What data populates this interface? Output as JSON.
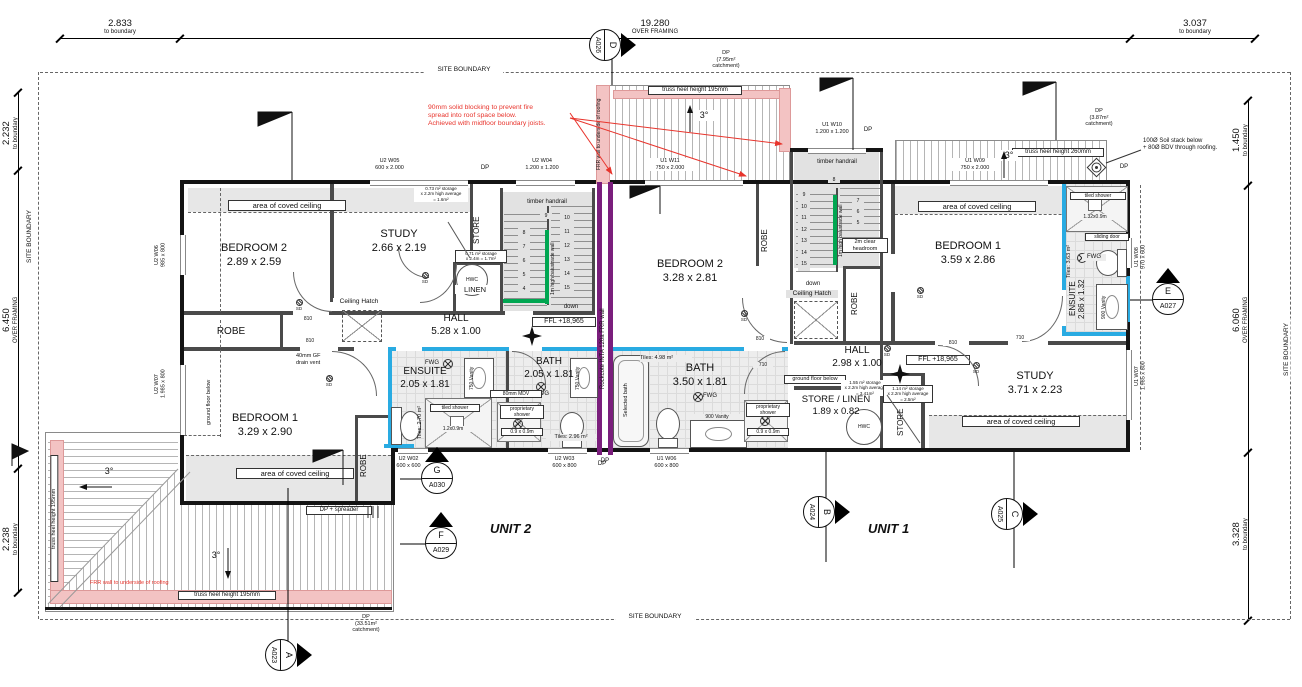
{
  "colors": {
    "frr_purple": "#7a1e7c",
    "wet_wall_cyan": "#29abe2",
    "balustrade_green": "#00a651",
    "annotation_red": "#e8342c",
    "frr_pink": "#f3c3c3"
  },
  "boundary_label": "SITE BOUNDARY",
  "dims": {
    "top_left": {
      "v": "2.833",
      "s": "to boundary"
    },
    "top_mid": {
      "v": "19.280",
      "s": "OVER FRAMING"
    },
    "top_right": {
      "v": "3.037",
      "s": "to boundary"
    },
    "left_top": {
      "v": "2.232",
      "s": "to boundary"
    },
    "left_mid": {
      "v": "6.450",
      "s": "OVER FRAMING"
    },
    "left_bot": {
      "v": "2.238",
      "s": "to boundary"
    },
    "right_top": {
      "v": "1.450",
      "s": "to boundary"
    },
    "right_mid": {
      "v": "6.060",
      "s": "OVER FRAMING"
    },
    "right_bot": {
      "v": "3.328",
      "s": "to boundary"
    }
  },
  "unit_labels": {
    "unit1": "UNIT 1",
    "unit2": "UNIT 2"
  },
  "markers": {
    "d": {
      "letter": "D",
      "sheet": "A026"
    },
    "e": {
      "letter": "E",
      "sheet": "A027"
    },
    "g": {
      "letter": "G",
      "sheet": "A030"
    },
    "f": {
      "letter": "F",
      "sheet": "A029"
    },
    "b": {
      "letter": "B",
      "sheet": "A024"
    },
    "c": {
      "letter": "C",
      "sheet": "A025"
    },
    "a": {
      "letter": "A",
      "sheet": "A023"
    }
  },
  "notes": {
    "fire_blocking": "90mm solid blocking to prevent fire\nspread into roof space below.\nAchieved with midfloor boundary joists.",
    "frr_underside": "FRR wall to underside of roofing",
    "frr_underside_2": "FRR wall to underside of roofing",
    "rockcote_wall": "Rockcote  INTA 120a FRR wall",
    "soil_stack": "100Ø Soil stack below\n+ 80Ø BDV through roofing.",
    "truss_195": "truss heel height 195mm",
    "truss_260": "truss heel height 260mm",
    "slope": "3°",
    "dp": "DP",
    "dp_spreader": "DP + spreader",
    "dp_795": "DP\n(7.95m²\ncatchment)",
    "dp_387": "DP\n(3.87m²\ncatchment)",
    "dp_3351": "DP\n(33.51m²\ncatchment)",
    "coved_ceiling": "area of coved ceiling",
    "ground_floor_below": "ground floor below",
    "ceiling_hatch": "Ceiling Hatch",
    "drain_vent": "40mm GF\ndrain vent",
    "sd": "SD",
    "fwg": "FWG",
    "mdv": "80mm MDV",
    "sliding_door": "sliding door"
  },
  "doors": {
    "d810": "810",
    "d710": "710"
  },
  "windows": {
    "u2w05": {
      "name": "U2 W05",
      "size": "600 x 2.000"
    },
    "u2w04": {
      "name": "U2 W04",
      "size": "1.200 x 1.200"
    },
    "u1w11": {
      "name": "U1 W11",
      "size": "750 x 2.000"
    },
    "u1w10": {
      "name": "U1 W10",
      "size": "1.200 x 1.200"
    },
    "u1w09": {
      "name": "U1 W09",
      "size": "750 x 2.000"
    },
    "u2w06": {
      "name": "U2 W06",
      "size": "985 x 800"
    },
    "u2w07": {
      "name": "U2 W07",
      "size": "1.985 x 800"
    },
    "u2w02": {
      "name": "U2 W02",
      "size": "600 x 600"
    },
    "u2w03": {
      "name": "U2 W03",
      "size": "600 x 800"
    },
    "u1w06": {
      "name": "U1 W06",
      "size": "600 x 800"
    },
    "u1w08": {
      "name": "U1 W08",
      "size": "970 x 600"
    },
    "u1w07": {
      "name": "U1 W07",
      "size": "1.985 x 800"
    }
  },
  "stairs": {
    "u2": {
      "handrail": "timber handrail",
      "balustrade": "1m high balustrade wall",
      "up_numbers": "8\n7\n6\n5\n4",
      "top_number": "9",
      "down_numbers": "10\n11\n12\n13\n14\n15",
      "down": "down",
      "ffl": "FFL +18,965"
    },
    "u1": {
      "handrail": "timber handrail",
      "balustrade": "1m high balustrade wall",
      "down_numbers": "9\n10\n11\n12\n13\n14\n15",
      "top_number": "8",
      "up_numbers": "7\n6\n5",
      "headroom": "2m clear headroom",
      "down": "down",
      "ffl": "FFL +18,965"
    }
  },
  "unit2_rooms": {
    "bedroom2": {
      "name": "BEDROOM 2",
      "size": "2.89 x 2.59"
    },
    "study": {
      "name": "STUDY",
      "size": "2.66 x 2.19"
    },
    "store": "STORE",
    "store_note": "0.73 m² storage\nx 2.2m high average\n= 1.6m²",
    "hwc": "HWC",
    "linen": "LINEN",
    "linen_note": "0.71 m² storage\nx 2.4m = 1.7m²",
    "hall": {
      "name": "HALL",
      "size": "5.28 x 1.00"
    },
    "robe_a": "ROBE",
    "robe_b": "ROBE",
    "bedroom1": {
      "name": "BEDROOM 1",
      "size": "3.29 x 2.90"
    },
    "ensuite": {
      "name": "ENSUITE",
      "size": "2.05 x 1.81"
    },
    "ensuite_tiles": "Tiles: 2.70 m²",
    "ensuite_shower": "tiled shower",
    "ensuite_shower_size": "1.2x0.9m",
    "ensuite_vanity": "750 Vanity",
    "bath": {
      "name": "BATH",
      "size": "2.05 x 1.81"
    },
    "bath_tiles": "Tiles: 2.96 m²",
    "bath_vanity": "750 Vanity",
    "prop_shower": "proprietary\nshower",
    "prop_shower_size": "0.9 x 0.9m"
  },
  "unit1_rooms": {
    "bedroom2": {
      "name": "BEDROOM 2",
      "size": "3.28 x 2.81"
    },
    "robe_a": "ROBE",
    "robe_b": "ROBE",
    "bedroom1": {
      "name": "BEDROOM 1",
      "size": "3.59 x 2.86"
    },
    "ensuite": {
      "name": "ENSUITE",
      "size": "2.86 x 1.32"
    },
    "ensuite_tiles": "Tiles: 3.63 m²",
    "ensuite_shower": "tiled shower",
    "ensuite_shower_size": "1.32x0.9m",
    "ensuite_vanity": "900 Vanity",
    "hall": {
      "name": "HALL",
      "size": "2.98 x 1.00"
    },
    "hall_store_note": "1.55 m² storage\nx 2.2m high average\n= 3.41m²",
    "store_linen": {
      "name": "STORE / LINEN",
      "size": "1.89 x 0.82"
    },
    "hwc": "HWC",
    "store": "STORE",
    "store_note": "1.14 m² storage\nx 2.2m high average\n= 2.5m²",
    "bath": {
      "name": "BATH",
      "size": "3.50 x 1.81"
    },
    "bath_tiles": "Tiles: 4.98 m²",
    "selected_bath": "Selected bath",
    "bath_vanity": "900 Vanity",
    "prop_shower": "proprietary\nshower",
    "prop_shower_size": "0.9 x 0.9m",
    "study": {
      "name": "STUDY",
      "size": "3.71 x 2.23"
    }
  }
}
